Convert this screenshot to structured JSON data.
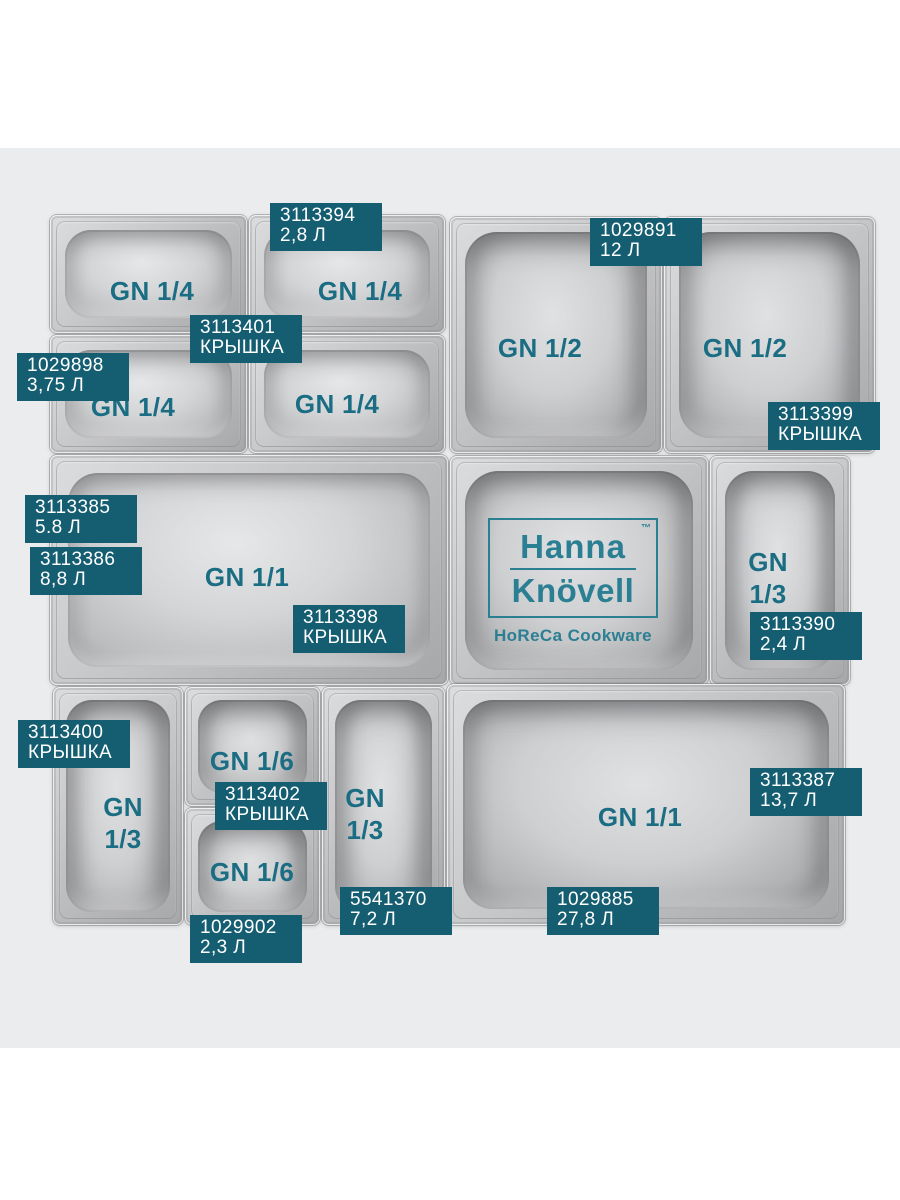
{
  "page": {
    "background": "#ffffff",
    "backdrop_color": "#ebecee"
  },
  "colors": {
    "tag_background": "#155e72",
    "tag_text": "#ffffff",
    "pan_caption": "#1b6d83",
    "brand": "#2b7f93"
  },
  "brand": {
    "name_top": "Hanna",
    "name_bottom": "Knövell",
    "trademark": "™",
    "tagline": "HoReCa Cookware"
  },
  "pans": [
    {
      "label": "GN 1/4"
    },
    {
      "label": "GN 1/4"
    },
    {
      "label": "GN 1/4"
    },
    {
      "label": "GN 1/4"
    },
    {
      "label": "GN 1/2"
    },
    {
      "label": "GN 1/2"
    },
    {
      "label": "GN 1/1"
    },
    {
      "label": "GN\n1/3"
    },
    {
      "label": "GN\n1/3"
    },
    {
      "label": "GN 1/6"
    },
    {
      "label": "GN 1/6"
    },
    {
      "label": "GN\n1/3"
    },
    {
      "label": "GN 1/1"
    }
  ],
  "tags": [
    {
      "code": "3113394",
      "size": "2,8 Л"
    },
    {
      "code": "1029891",
      "size": "12 Л"
    },
    {
      "code": "3113401",
      "size": "КРЫШКА"
    },
    {
      "code": "1029898",
      "size": "3,75 Л"
    },
    {
      "code": "3113399",
      "size": "КРЫШКА"
    },
    {
      "code": "3113385",
      "size": "5.8 Л"
    },
    {
      "code": "3113386",
      "size": "8,8 Л"
    },
    {
      "code": "3113398",
      "size": "КРЫШКА"
    },
    {
      "code": "3113390",
      "size": "2,4 Л"
    },
    {
      "code": "3113400",
      "size": "КРЫШКА"
    },
    {
      "code": "3113402",
      "size": "КРЫШКА"
    },
    {
      "code": "3113387",
      "size": "13,7 Л"
    },
    {
      "code": "1029885",
      "size": "27,8 Л"
    },
    {
      "code": "5541370",
      "size": "7,2 Л"
    },
    {
      "code": "1029902",
      "size": "2,3 Л"
    }
  ]
}
